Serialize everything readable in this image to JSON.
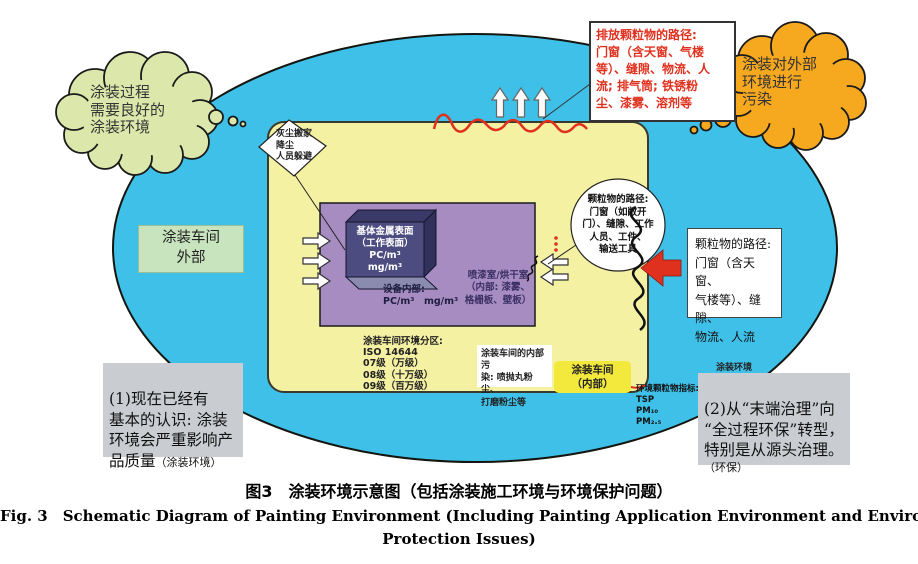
{
  "colors": {
    "sky": "#3EC0E8",
    "workshop_yellow": "#F5F1A3",
    "booth_purple": "#A78CC2",
    "box_front": "#4C4C80",
    "box_top": "#3A3A68",
    "box_side": "#31315C",
    "box_base": "#8B8BB0",
    "cloud_green": "#DCE8AB",
    "cloud_orange": "#F6A81F",
    "outside_green": "#C8E4BE",
    "inner_yellow": "#F2E93C",
    "note_gray": "#C9CDD2",
    "alert_red": "#E0301E"
  },
  "diagram": {
    "left_thought": "涂装过程\n需要良好的\n涂装环境",
    "right_thought": "涂装对外部\n环境进行\n污染",
    "emission_path_note": "排放颗粒物的路径:\n门窗（含天窗、气楼\n等）、缝隙、物流、人\n流; 排气筒; 铁锈粉\n尘、漆雾、溶剂等",
    "dust_note": "灰尘搬家\n降尘\n人员躲避",
    "workshop_outside_label": "涂装车间\n外部",
    "substrate_surface": "基体金属表面\n（工作表面）\nPC/m³\nmg/m³",
    "equipment_interior": "设备内部:\nPC/m³　mg/m³",
    "spray_dry_room": "喷漆室/烘干室\n（内部: 漆雾、\n格栅板、壁板）",
    "particle_path_circle": "颗粒物的路径:\n门窗（如敞开\n门）、缝隙、工作\n人员、工件、\n输送工具",
    "particle_path_box": "颗粒物的路径:\n门窗（含天窗、\n气楼等）、缝隙、\n物流、人流",
    "cleanliness_zoning": "涂装车间环境分区:\nISO 14644\n07级（万级）\n08级（十万级）\n09级（百万级）",
    "internal_pollution": "涂装车间的内部污\n染: 喷抛丸粉尘、\n打磨粉尘等",
    "workshop_inner_label": "涂装车间\n（内部）",
    "env_particle_indicators": "环境颗粒物指标:\nTSP\nPM₁₀\nPM₂.₅",
    "env_label": "涂装环境",
    "insight1": {
      "text": "(1)现在已经有\n基本的认识: 涂装\n环境会严重影响产\n品质量",
      "note": "（涂装环境）"
    },
    "insight2": {
      "text": "(2)从“末端治理”向\n“全过程环保”转型，\n特别是从源头治理。",
      "note": "（环保）"
    }
  },
  "caption": {
    "cn": "图3　涂装环境示意图（包括涂装施工环境与环境保护问题）",
    "en_line1": "Fig. 3　Schematic Diagram of Painting Environment (Including Painting Application Environment and Environmental",
    "en_line2": "Protection Issues)"
  }
}
